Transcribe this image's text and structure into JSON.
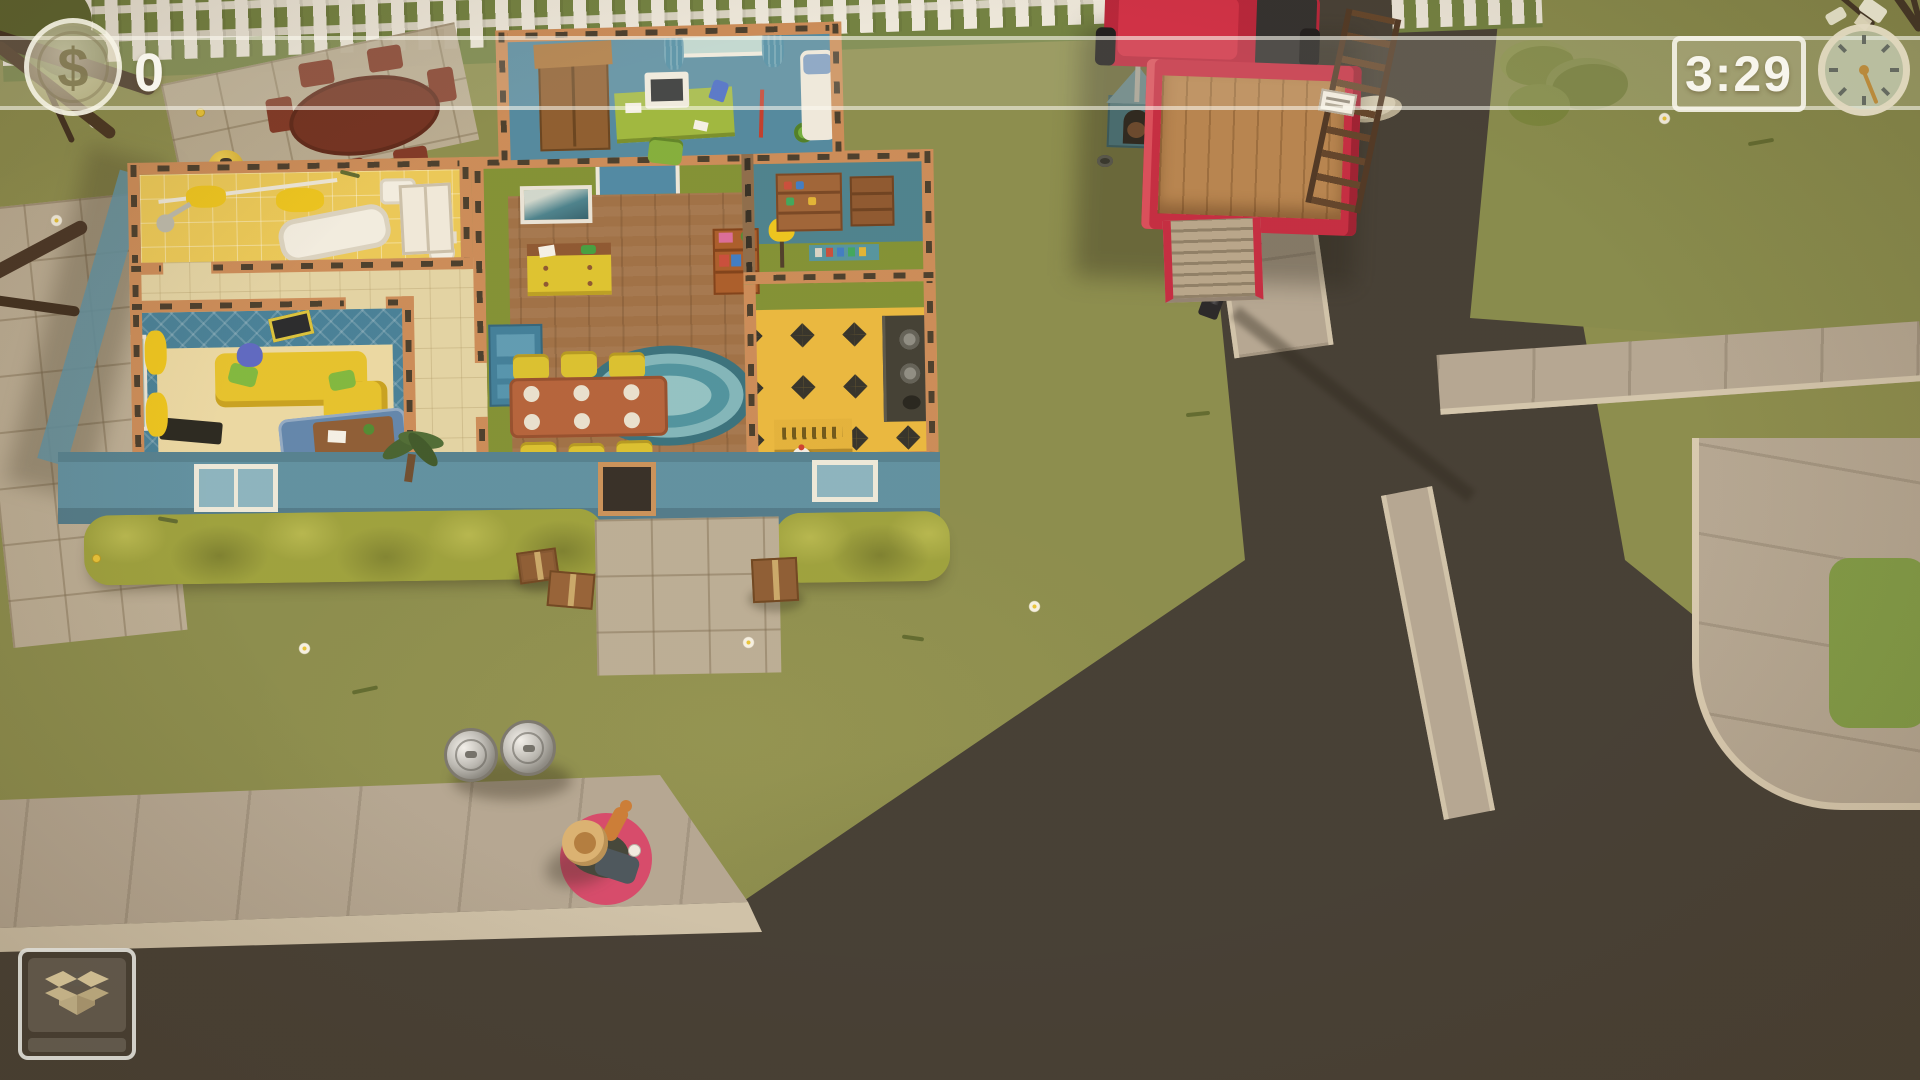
{
  "hud": {
    "money": {
      "currency_symbol": "$",
      "value": "0"
    },
    "timer": {
      "value": "3:29",
      "icon": "stopwatch-icon"
    },
    "box_panel": {
      "icon": "open-cardboard-box-icon"
    }
  },
  "palette": {
    "grass": "#878b4c",
    "road": "#3e3a33",
    "sidewalk": "#b2a694",
    "curb": "#d2c6af",
    "hud_border": "#f8f6ee",
    "truck_red": "#c22740",
    "selection_ring": "#d5466b",
    "wall_wood": "#c98a58",
    "exterior_wall": "#5b8fa3",
    "hedge": "#9aa03c",
    "bathroom_tile": "#eac957",
    "bedroom_wallpaper": "#417e99",
    "living_wall": "#7e9033",
    "wood_floor": "#9c6e45",
    "kitchen_floor": "#e9b83e",
    "office_floor": "#4d87a1",
    "fence": "#ece9df"
  },
  "scene": {
    "house": {
      "rooms": [
        {
          "name": "bathroom"
        },
        {
          "name": "hallway"
        },
        {
          "name": "master-bedroom"
        },
        {
          "name": "living-dining-room"
        },
        {
          "name": "kitchen"
        },
        {
          "name": "pantry"
        },
        {
          "name": "office-bedroom"
        }
      ]
    },
    "objects": [
      "moving-truck",
      "street-lamp",
      "dog-house",
      "picket-fence",
      "hedge",
      "outdoor-dining-set",
      "bbq-grill",
      "trash-cans",
      "moving-boxes",
      "walkway",
      "player-character",
      "selection-ring",
      "chicken",
      "oval-rug",
      "sofa",
      "dining-table"
    ]
  }
}
